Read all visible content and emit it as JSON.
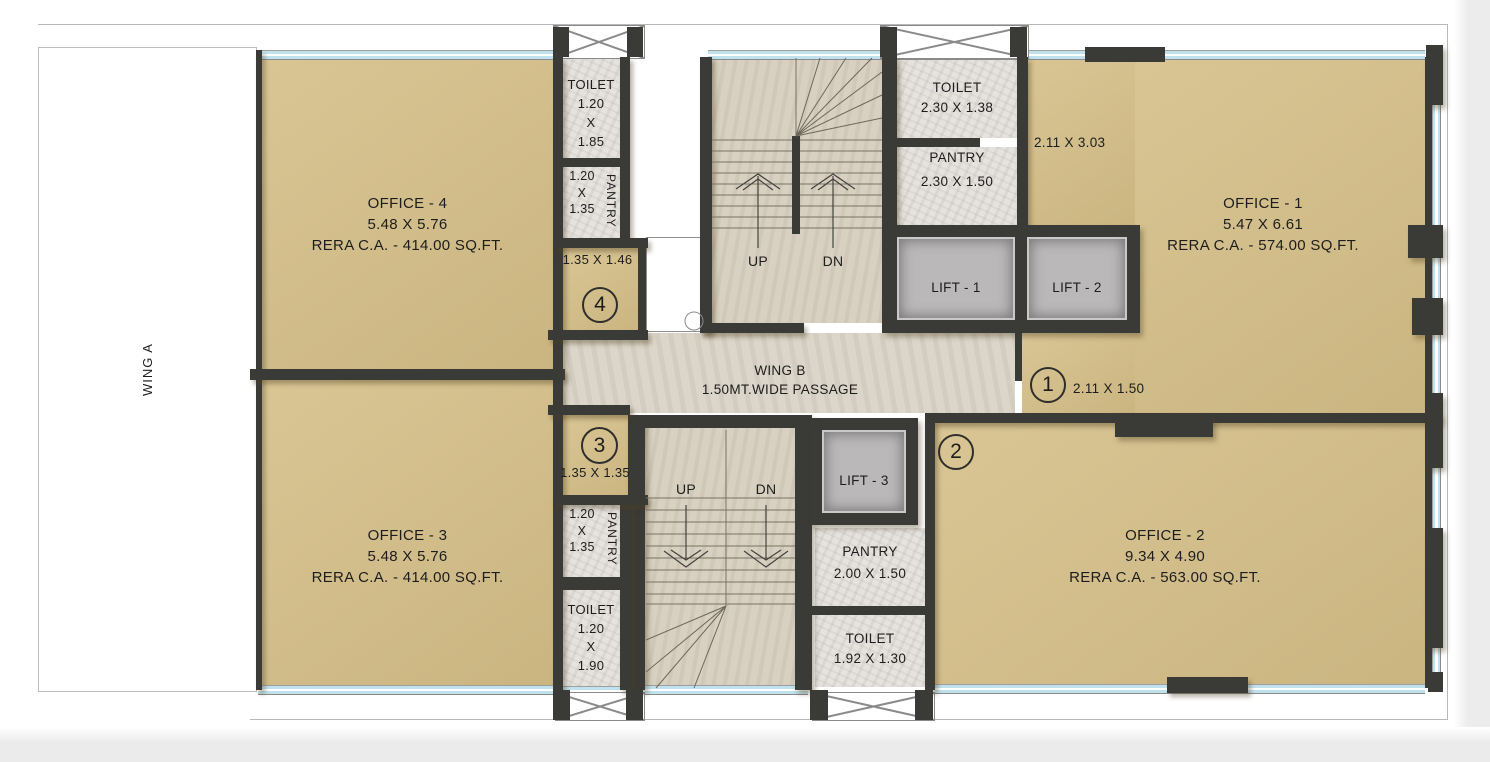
{
  "title": "Wing B office floor plan",
  "wing_a_label": "WING A",
  "passage": {
    "line1": "WING B",
    "line2": "1.50MT.WIDE PASSAGE"
  },
  "offices": {
    "o1": {
      "name": "OFFICE - 1",
      "dims": "5.47 X 6.61",
      "rera": "RERA C.A. - 574.00 SQ.FT."
    },
    "o2": {
      "name": "OFFICE - 2",
      "dims": "9.34 X 4.90",
      "rera": "RERA C.A. - 563.00 SQ.FT."
    },
    "o3": {
      "name": "OFFICE - 3",
      "dims": "5.48 X 5.76",
      "rera": "RERA C.A. - 414.00 SQ.FT."
    },
    "o4": {
      "name": "OFFICE - 4",
      "dims": "5.48 X 5.76",
      "rera": "RERA C.A. - 414.00 SQ.FT."
    }
  },
  "rooms": {
    "toilet_top_left": {
      "lines": [
        "TOILET",
        "1.20",
        "X",
        "1.85"
      ]
    },
    "pantry_top_left": {
      "label": "PANTRY",
      "lines": [
        "1.20",
        "X",
        "1.35"
      ]
    },
    "pantry_bottom_left": {
      "label": "PANTRY",
      "lines": [
        "1.20",
        "X",
        "1.35"
      ]
    },
    "toilet_bottom_left": {
      "lines": [
        "TOILET",
        "1.20",
        "X",
        "1.90"
      ]
    },
    "toilet_top_mid": {
      "name": "TOILET",
      "dims": "2.30 X 1.38"
    },
    "pantry_top_mid": {
      "name": "PANTRY",
      "dims": "2.30 X 1.50"
    },
    "pantry_bottom_mid": {
      "name": "PANTRY",
      "dims": "2.00 X 1.50"
    },
    "toilet_bottom_mid": {
      "name": "TOILET",
      "dims": "1.92 X 1.30"
    }
  },
  "lifts": {
    "l1": "LIFT - 1",
    "l2": "LIFT - 2",
    "l3": "LIFT - 3"
  },
  "stairs": {
    "up": "UP",
    "dn": "DN"
  },
  "markers": {
    "m1": {
      "num": "1",
      "dims": "2.11 X 1.50"
    },
    "m2": {
      "num": "2"
    },
    "m3": {
      "num": "3",
      "dims": "1.35 X 1.35"
    },
    "m4": {
      "num": "4",
      "dims": "1.35 X 1.46"
    }
  },
  "annotations": {
    "niche_dims": "2.11 X 3.03"
  },
  "colors": {
    "wall": "#3a3a37",
    "office_fill": "#d5bf88",
    "marble_fill": "#e6e3df",
    "stair_fill": "#d8d1c1",
    "passage_fill": "#dcd6ca",
    "lift_fill": "#bab8b9",
    "window_glass": "#bfe2ee"
  }
}
